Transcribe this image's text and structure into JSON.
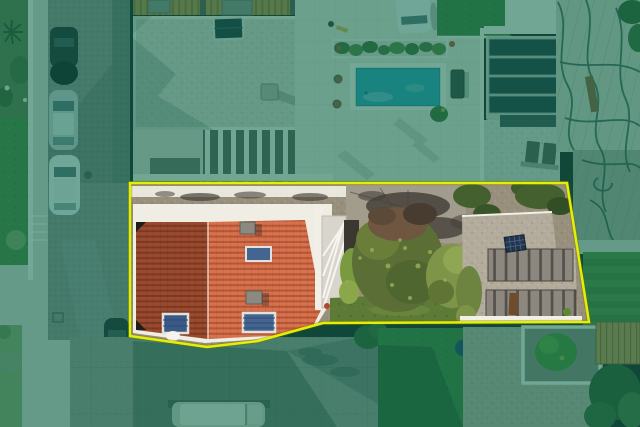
{
  "palette": {
    "overlay_tint": "#0a6b52",
    "boundary_yellow": "#e4ef04",
    "boundary_under": "#6b7000",
    "street_cobble": "#8e8d8a",
    "street_slab": "#98958c",
    "sidewalk": "#d6d3c9",
    "lawn": "#49833a",
    "lawn_pale": "#8aa268",
    "lawn_stripe_a": "#55883c",
    "lawn_stripe_b": "#497a33",
    "grass_dark": "#3f7a33",
    "building_white": "#f0ede4",
    "white_wall": "#f2efe6",
    "gravel_roof": "#d7d3c7",
    "patio_tile": "#e3dfd2",
    "pool_water": "#2d9fb5",
    "glass_dark": "#22333a",
    "glass_frame": "#cac7bb",
    "slat_a": "#b5883c",
    "slat_b": "#8f6a2e",
    "construction_a": "#ccccbe",
    "construction_b": "#a8a89a",
    "cable": "#2a4a40",
    "plank": "#8a5a30",
    "car_dark": "#232526",
    "car_silver": "#c6cdcf",
    "car_white": "#eceeee",
    "van_body": "#cfccc2",
    "window_tint": "#5d7178",
    "dirt": "#988f7d",
    "dirt_light": "#c7c1b2",
    "burnt": "#45413a",
    "tile_dark_a": "#9c4a2e",
    "tile_dark_b": "#7c3a24",
    "tile_orange_a": "#d6734c",
    "tile_orange_b": "#b65539",
    "skylight_glass": "#44658f",
    "skylight_glass2": "#3a5a85",
    "skylight_frame": "#e3e1dc",
    "chimney": "#8a8a80",
    "stairs_panel": "#d8d5cc",
    "door_dark": "#3a3830",
    "tree_olive": "#5a6e35",
    "tree_green": "#7e9448",
    "tree_light": "#93a855",
    "tree_maroon": "#6e5640",
    "tree_dark_brown": "#473c2f",
    "bush_green": "#7a9a3f",
    "foliage_dark": "#33592b",
    "garage_panel": "#8c8880",
    "garage_gap": "#55514a",
    "garage_gravel": "#b3ab9b",
    "solar_panel": "#24364f",
    "rust_door": "#6e4c2c",
    "courtyard_floor": "#8a8578",
    "courtyard_tree": "#4a8a2f",
    "brown_roof": "#bd8f4a",
    "brown_roof_rib": "#8a6530",
    "blue_tank": "#1d3f6e",
    "pot_red": "#b5472a"
  }
}
